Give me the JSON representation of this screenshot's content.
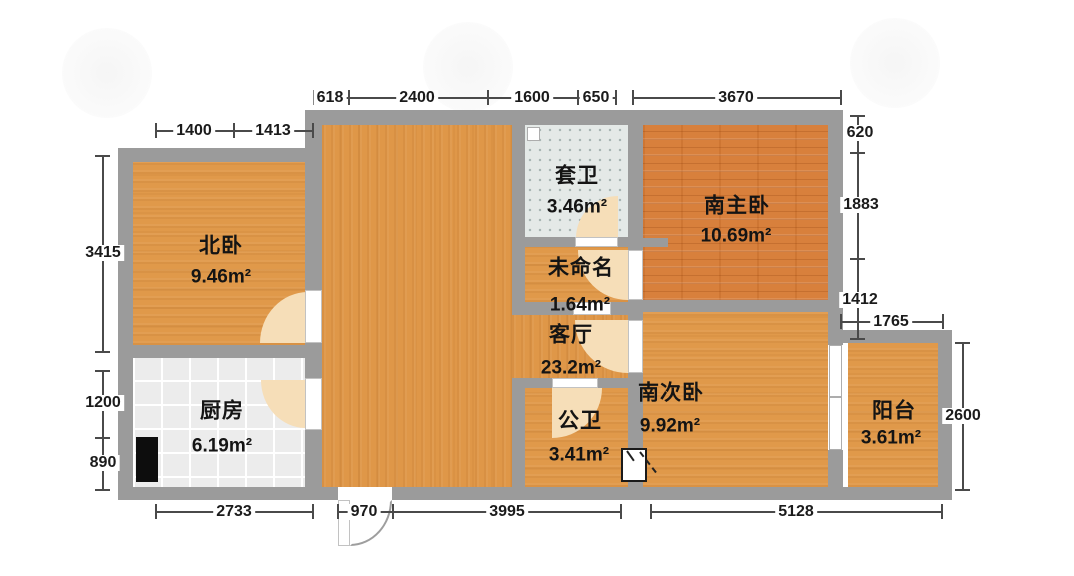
{
  "plan_type": "apartment-floor-plan",
  "rooms": {
    "north_bedroom": {
      "name": "北卧",
      "area": "9.46m²"
    },
    "kitchen": {
      "name": "厨房",
      "area": "6.19m²"
    },
    "suite_bath": {
      "name": "套卫",
      "area": "3.46m²"
    },
    "unnamed": {
      "name": "未命名",
      "area": "1.64m²"
    },
    "living": {
      "name": "客厅",
      "area": "23.2m²"
    },
    "public_bath": {
      "name": "公卫",
      "area": "3.41m²"
    },
    "south_master": {
      "name": "南主卧",
      "area": "10.69m²"
    },
    "south_second": {
      "name": "南次卧",
      "area": "9.92m²"
    },
    "balcony": {
      "name": "阳台",
      "area": "3.61m²"
    }
  },
  "dims": {
    "top_618": "618",
    "top_2400": "2400",
    "top_1600": "1600",
    "top_650": "650",
    "top_3670": "3670",
    "north_1400": "1400",
    "north_1413": "1413",
    "left_3415": "3415",
    "left_1200": "1200",
    "left_890": "890",
    "right_620": "620",
    "right_1883": "1883",
    "right_1412": "1412",
    "balcony_1765": "1765",
    "balcony_2600": "2600",
    "bottom_2733": "2733",
    "bottom_970": "970",
    "bottom_3995": "3995",
    "bottom_5128": "5128"
  },
  "colors": {
    "wall": "#9b9b9b",
    "wood_light": "#e0994a",
    "wood_master": "#d8803c",
    "bath_tile": "#e4e9e7",
    "kitchen_tile": "#ececec",
    "door_arc": "#f6deb8",
    "dimension_line": "#4a4a4a"
  }
}
